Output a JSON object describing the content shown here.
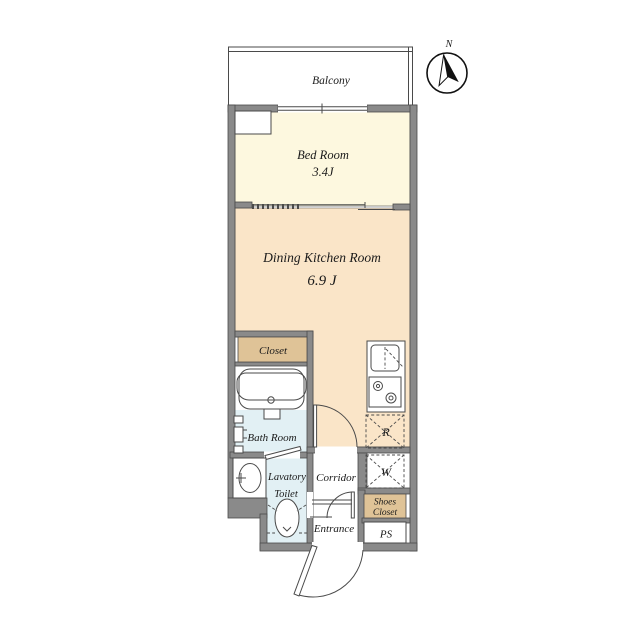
{
  "compass": {
    "label": "N"
  },
  "rooms": {
    "balcony": {
      "label": "Balcony"
    },
    "bedroom": {
      "label": "Bed Room",
      "size": "3.4J"
    },
    "dining_kitchen": {
      "label": "Dining Kitchen Room",
      "size": "6.9 J"
    },
    "closet": {
      "label": "Closet"
    },
    "bathroom": {
      "label": "Bath Room"
    },
    "lavatory": {
      "label_line1": "Lavatory",
      "label_line2": "Toilet"
    },
    "corridor": {
      "label": "Corridor"
    },
    "entrance": {
      "label": "Entrance"
    },
    "shoes_closet": {
      "label_line1": "Shoes",
      "label_line2": "Closet"
    },
    "pipe_space": {
      "label": "PS"
    },
    "refrigerator_space": {
      "label": "R"
    },
    "washer_space": {
      "label": "W"
    }
  },
  "colors": {
    "bedroom_floor": "#fdf8df",
    "dining_kitchen_floor": "#fae5c8",
    "closet_fill": "#dfc397",
    "wet_area_fill": "#e2f0f4",
    "wall": "#8a8a8a",
    "line": "#4a4a4a",
    "text": "#1a1a1a"
  }
}
